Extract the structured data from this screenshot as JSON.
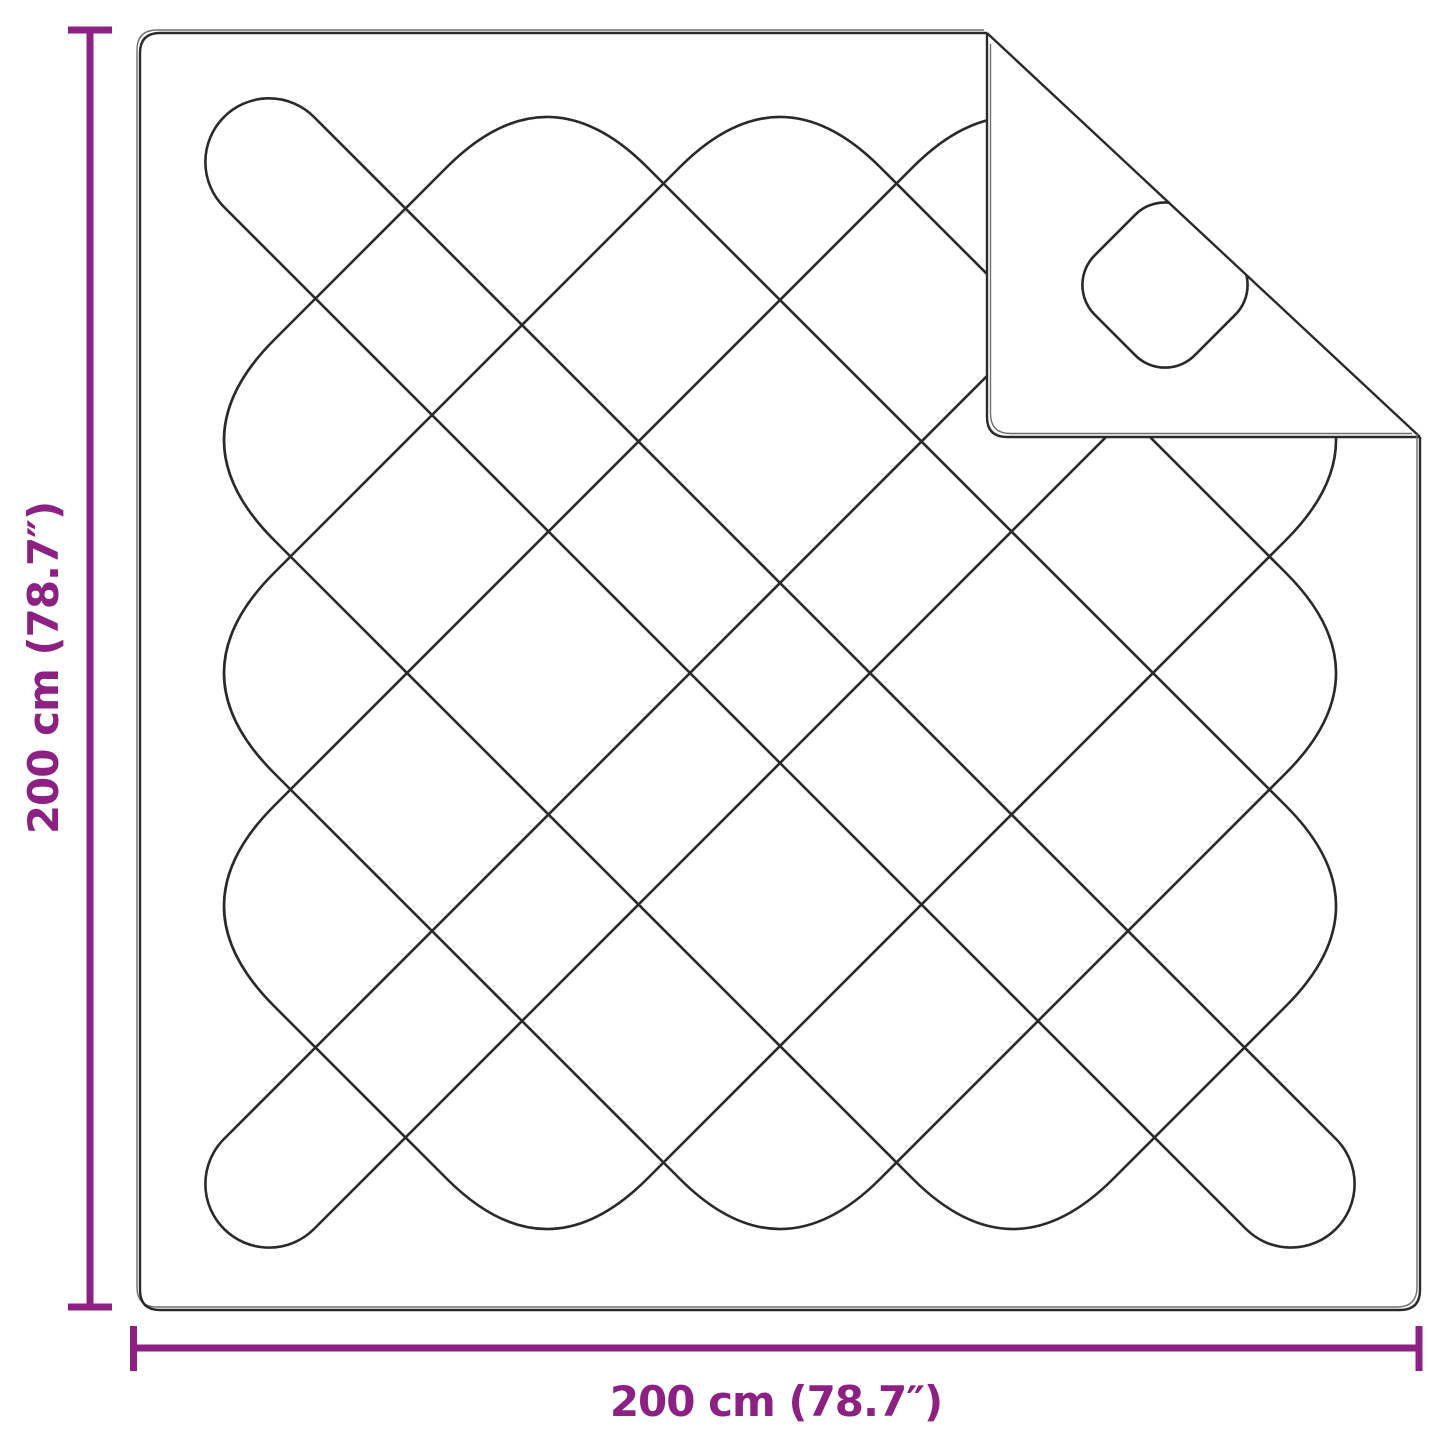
{
  "product_diagram": {
    "type_note": "quilted blanket with folded corner",
    "vertical_dimension_label": "200 cm (78.7″)",
    "horizontal_dimension_label": "200 cm (78.7″)"
  },
  "colors": {
    "dimension_accent": "#8C2183",
    "drawing_line": "#2a2a2a",
    "outline_ghost": "#6e6e6e",
    "background": "#ffffff"
  }
}
